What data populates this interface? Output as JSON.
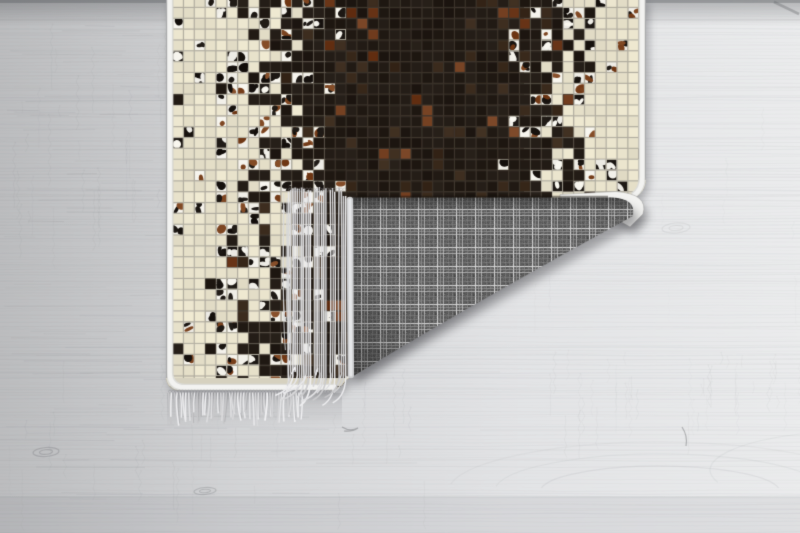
{
  "meta": {
    "type": "product-photo",
    "alt": "Patchwork cowhide-style mosaic rug lying on a light grey wooden plank floor; the bottom right corner is folded over showing a grey tartan woven backing and pale fringe tassels",
    "subject": "mosaic patchwork rug with folded corner",
    "background": "whitewashed grey wood plank floor"
  },
  "palette": {
    "floor_left": "#bcbdbf",
    "floor_mid": "#d3d4d6",
    "floor_right": "#ebeced",
    "floor_top_shade": "#46484c",
    "grain": "#85878a",
    "tile_cream": "#e8e2cb",
    "tile_cream_grout": "#b3afa2",
    "tile_dark": "#211a14",
    "tile_dark_grout": "#3b332b",
    "tile_rust": "#6e3a1c",
    "cowhide_white": "#f3f1ea",
    "cowhide_black": "#1a1511",
    "cowhide_brown": "#7a421e",
    "binding_white": "#f3f3f1",
    "binding_edge": "#dcdcd8",
    "fringe_light": "#e6e7e9",
    "fringe_mid": "#cbccce",
    "fringe_dark": "#a7a8aa",
    "plaid_base": "#5e5e5e",
    "plaid_line_bright": "#d6d6d6",
    "plaid_line_mid": "#a8a8a8",
    "shadow": "rgba(55,55,60,0.40)"
  },
  "rug_parts": {
    "front": "mosaic tiles: cream borders, black-brown centre, scattered cow-hide patches",
    "backing": "grey tartan check weave",
    "fringe": "pale grey twisted fringe tassels",
    "edge": "white fabric binding"
  }
}
